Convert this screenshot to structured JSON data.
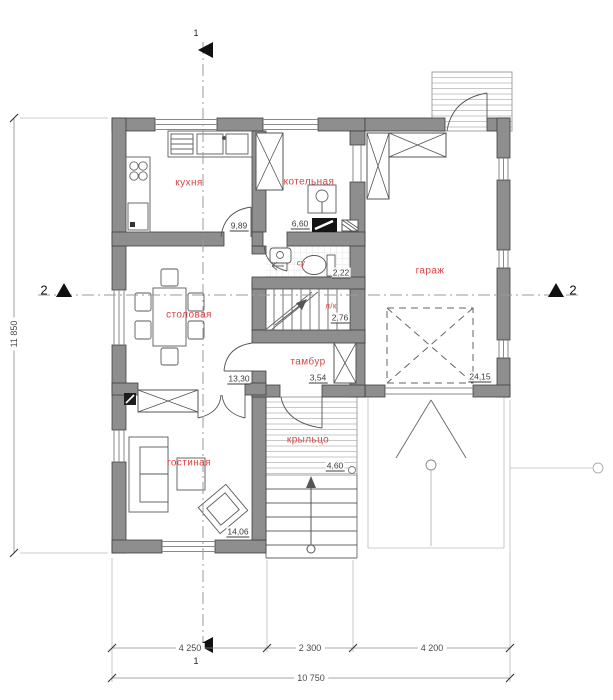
{
  "plan": {
    "rooms": [
      {
        "name": "kitchen",
        "label": "кухня",
        "area": "9,89"
      },
      {
        "name": "boiler",
        "label": "котельная",
        "area": "6,60"
      },
      {
        "name": "bathroom",
        "label": "су",
        "area": "2,22"
      },
      {
        "name": "staircase",
        "label": "л/к",
        "area": "2,76"
      },
      {
        "name": "dining",
        "label": "столовая",
        "area": "13,30"
      },
      {
        "name": "vestibule",
        "label": "тамбур",
        "area": "3,54"
      },
      {
        "name": "living",
        "label": "гостиная",
        "area": "14,06"
      },
      {
        "name": "porch",
        "label": "крыльцо",
        "area": "4,60"
      },
      {
        "name": "garage",
        "label": "гараж",
        "area": "24,15"
      }
    ],
    "dimensions": {
      "bottom_segments": [
        "4 250",
        "2 300",
        "4 200"
      ],
      "bottom_total": "10 750",
      "left_total": "11 850"
    },
    "sections": {
      "vertical": "1",
      "horizontal": "2"
    },
    "colors": {
      "wall": "#8e8e8e",
      "wall_outline": "#3f3f3f",
      "room_label": "#d84545",
      "dimension_text": "#4a4a4a",
      "hatch": "#c7c7c7"
    }
  }
}
